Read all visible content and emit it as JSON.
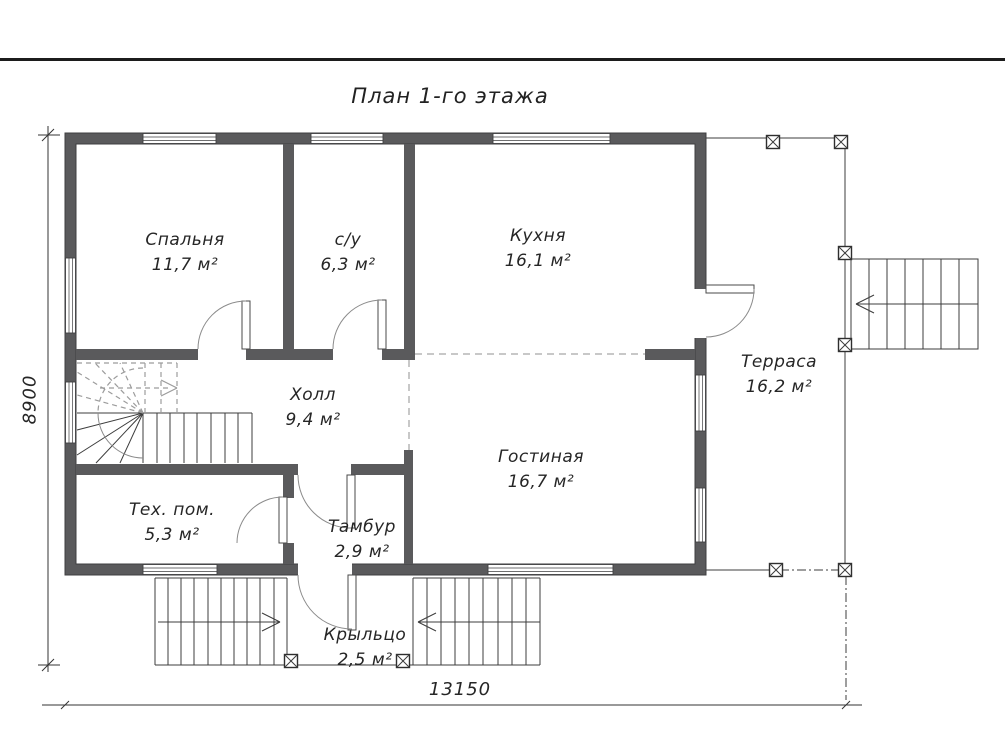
{
  "title": "План 1-го этажа",
  "rooms": [
    {
      "name": "Спальня",
      "area": "11,7 м²"
    },
    {
      "name": "с/у",
      "area": "6,3 м²"
    },
    {
      "name": "Кухня",
      "area": "16,1 м²"
    },
    {
      "name": "Терраса",
      "area": "16,2 м²"
    },
    {
      "name": "Холл",
      "area": "9,4 м²"
    },
    {
      "name": "Гостиная",
      "area": "16,7 м²"
    },
    {
      "name": "Тех. пом.",
      "area": "5,3 м²"
    },
    {
      "name": "Тамбур",
      "area": "2,9 м²"
    },
    {
      "name": "Крыльцо",
      "area": "2,5 м²"
    }
  ],
  "dimensions": {
    "width_mm": "13150",
    "height_mm": "8900"
  },
  "colors": {
    "wall": "#5a5a5c",
    "line": "#3c3c3c",
    "open_boundary_dash": "#b5b5b5",
    "hidden_stair_dash": "#9c9c9c",
    "text": "#262626",
    "background": "#ffffff"
  }
}
